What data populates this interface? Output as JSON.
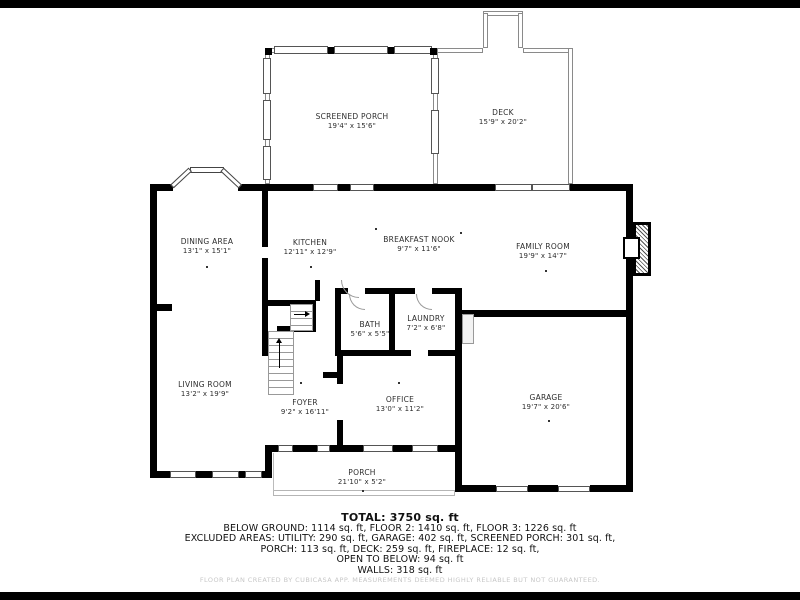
{
  "plan": {
    "type": "floor-plan",
    "colors": {
      "wall": "#000000",
      "background": "#ffffff",
      "window_border": "#555555",
      "thin_wall_border": "#8a8a8a",
      "letterbox": "#000000",
      "label_text": "#2e2e2e",
      "summary_text": "#111111",
      "disclaimer_text": "#c7c7c7"
    }
  },
  "rooms": [
    {
      "id": "screened-porch",
      "name": "SCREENED PORCH",
      "dims": "19'4\" x 15'6\"",
      "x": 352,
      "y": 121
    },
    {
      "id": "deck",
      "name": "DECK",
      "dims": "15'9\" x 20'2\"",
      "x": 503,
      "y": 117
    },
    {
      "id": "dining-area",
      "name": "DINING AREA",
      "dims": "13'1\" x 15'1\"",
      "x": 207,
      "y": 246
    },
    {
      "id": "kitchen",
      "name": "KITCHEN",
      "dims": "12'11\" x 12'9\"",
      "x": 310,
      "y": 247
    },
    {
      "id": "breakfast-nook",
      "name": "BREAKFAST NOOK",
      "dims": "9'7\" x 11'6\"",
      "x": 419,
      "y": 244
    },
    {
      "id": "family-room",
      "name": "FAMILY ROOM",
      "dims": "19'9\" x 14'7\"",
      "x": 543,
      "y": 251
    },
    {
      "id": "bath",
      "name": "BATH",
      "dims": "5'6\" x 5'5\"",
      "x": 370,
      "y": 329
    },
    {
      "id": "laundry",
      "name": "LAUNDRY",
      "dims": "7'2\" x 6'8\"",
      "x": 426,
      "y": 323
    },
    {
      "id": "living-room",
      "name": "LIVING ROOM",
      "dims": "13'2\" x 19'9\"",
      "x": 205,
      "y": 389
    },
    {
      "id": "foyer",
      "name": "FOYER",
      "dims": "9'2\" x 16'11\"",
      "x": 305,
      "y": 407
    },
    {
      "id": "office",
      "name": "OFFICE",
      "dims": "13'0\" x 11'2\"",
      "x": 400,
      "y": 404
    },
    {
      "id": "garage",
      "name": "GARAGE",
      "dims": "19'7\" x 20'6\"",
      "x": 546,
      "y": 402
    },
    {
      "id": "porch",
      "name": "PORCH",
      "dims": "21'10\" x 5'2\"",
      "x": 362,
      "y": 477
    }
  ],
  "summary": {
    "total": "TOTAL: 3750 sq. ft",
    "lines": [
      "BELOW GROUND: 1114 sq. ft, FLOOR 2: 1410 sq. ft, FLOOR 3: 1226 sq. ft",
      "EXCLUDED AREAS: UTILITY: 290 sq. ft, GARAGE: 402 sq. ft, SCREENED PORCH: 301 sq. ft,",
      "PORCH: 113 sq. ft, DECK: 259 sq. ft, FIREPLACE: 12 sq. ft,",
      "OPEN TO BELOW: 94 sq. ft",
      "WALLS: 318 sq. ft"
    ]
  },
  "footer": {
    "disclaimer": "FLOOR PLAN CREATED BY CUBICASA APP. MEASUREMENTS DEEMED HIGHLY RELIABLE BUT NOT GUARANTEED."
  }
}
